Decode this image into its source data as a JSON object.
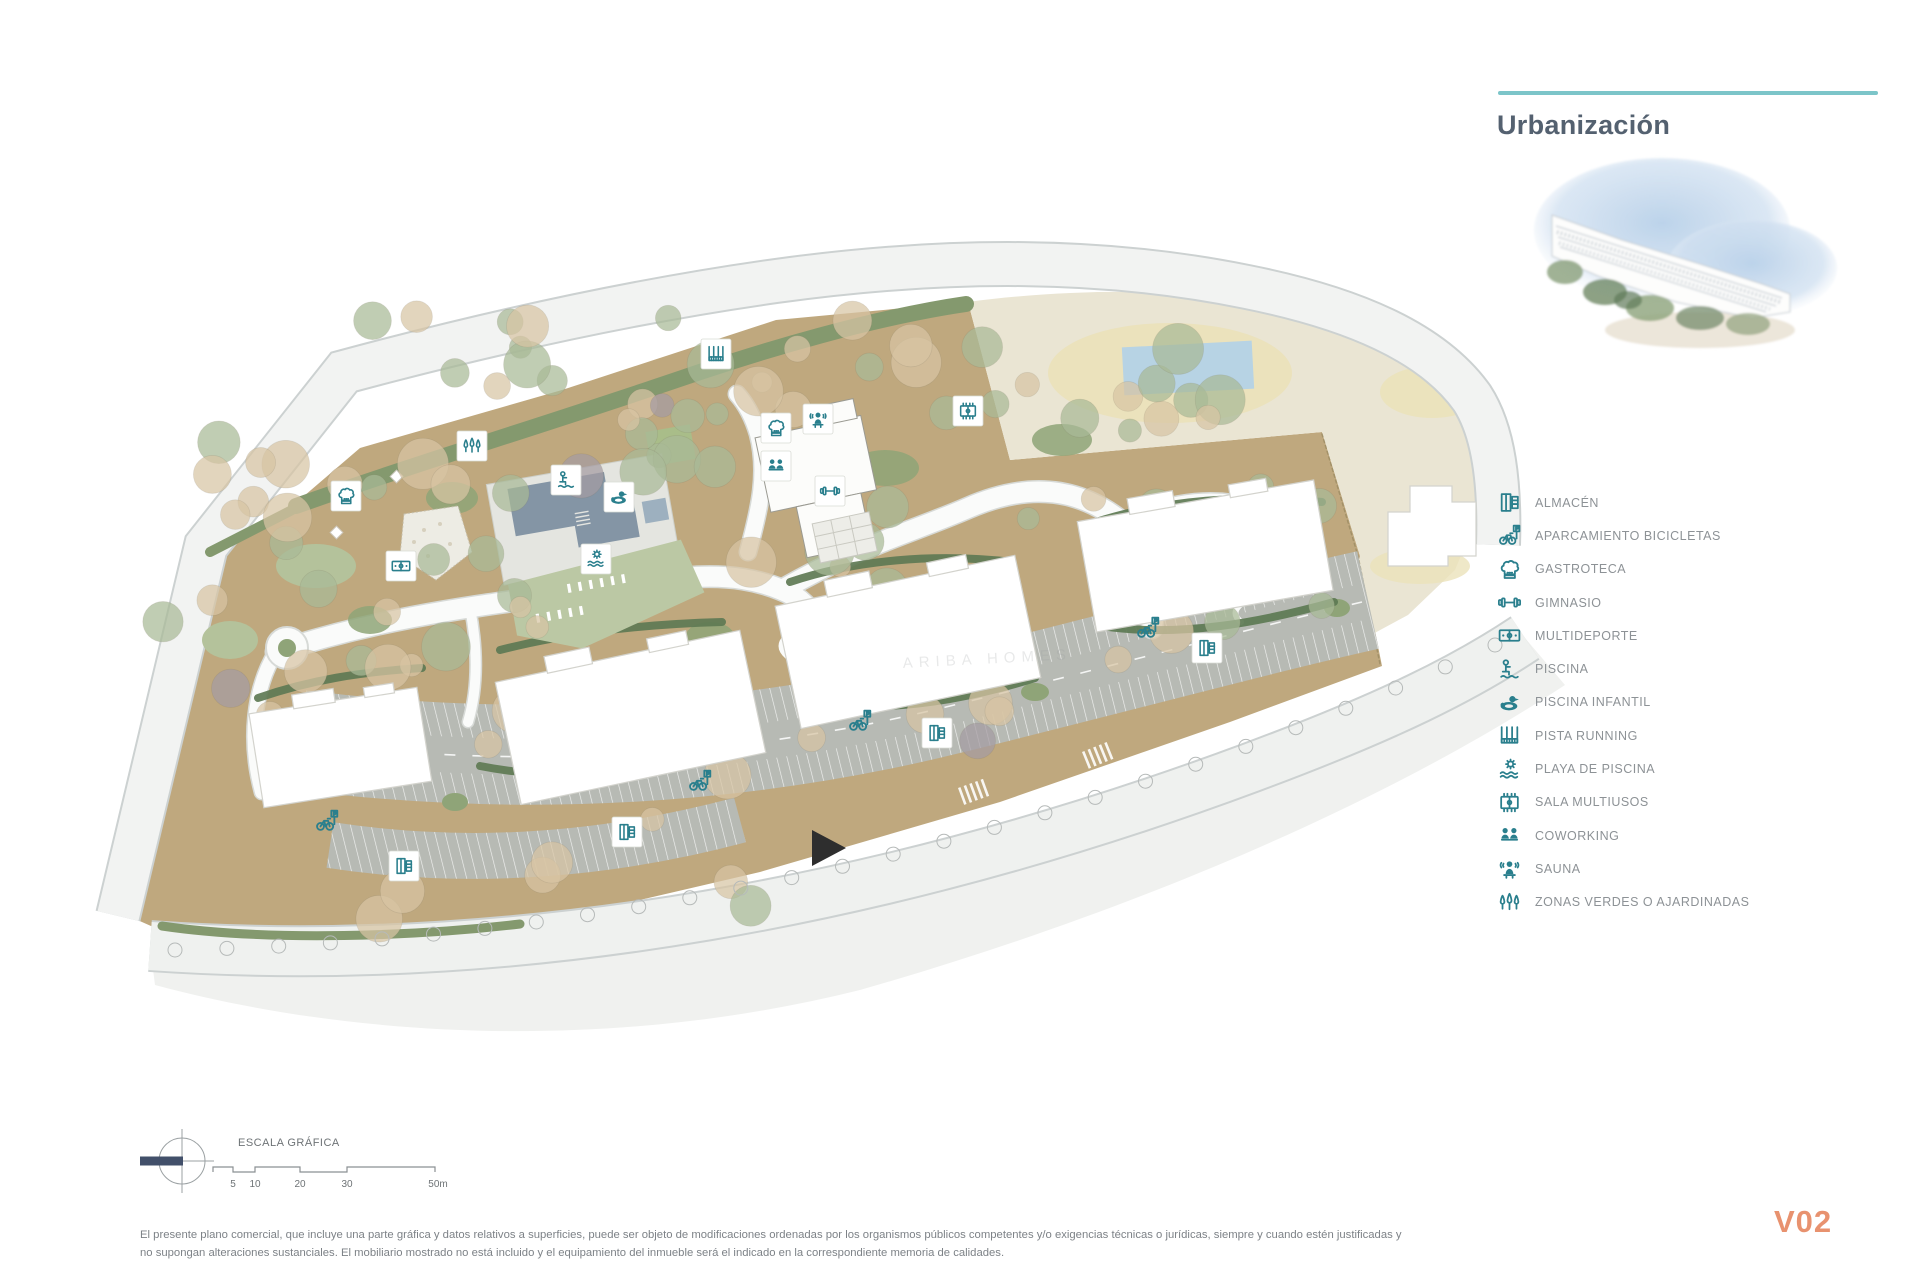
{
  "header": {
    "title": "Urbanización",
    "accent_line_color": "#7cc5c9",
    "title_color": "#546170"
  },
  "hero_image": {
    "description": "watercolor rendering of terraced apartment buildings with vegetation and blue sky"
  },
  "legend": {
    "items": [
      {
        "icon": "cabinet",
        "label": "ALMACÉN"
      },
      {
        "icon": "bike",
        "label": "APARCAMIENTO BICICLETAS"
      },
      {
        "icon": "chef",
        "label": "GASTROTECA"
      },
      {
        "icon": "gym",
        "label": "GIMNASIO"
      },
      {
        "icon": "court",
        "label": "MULTIDEPORTE"
      },
      {
        "icon": "pool",
        "label": "PISCINA"
      },
      {
        "icon": "duck",
        "label": "PISCINA INFANTIL"
      },
      {
        "icon": "track",
        "label": "PISTA RUNNING"
      },
      {
        "icon": "beach",
        "label": "PLAYA DE PISCINA"
      },
      {
        "icon": "multi",
        "label": "SALA MULTIUSOS"
      },
      {
        "icon": "cowork",
        "label": "COWORKING"
      },
      {
        "icon": "sauna",
        "label": "SAUNA"
      },
      {
        "icon": "trees",
        "label": "ZONAS VERDES O AJARDINADAS"
      }
    ]
  },
  "plan": {
    "watermark": "ARIBA HOMES",
    "colors": {
      "ground": "#bfa87e",
      "cream": "#eae5d3",
      "oval": "#ebe2ba",
      "water": "#b7d3e4",
      "pool": "#8495a5",
      "parking": "#b7bab4",
      "lawn": "#bbc8a4",
      "green_strip": "#84996e",
      "hedge": "#5e7a54",
      "icon_teal": "#2a7f8d"
    },
    "markers": [
      {
        "icon": "trees",
        "x": 472,
        "y": 446,
        "card": true
      },
      {
        "icon": "chef",
        "x": 346,
        "y": 496,
        "card": true
      },
      {
        "icon": "court",
        "x": 401,
        "y": 566,
        "card": true
      },
      {
        "icon": "track",
        "x": 716,
        "y": 354,
        "card": true
      },
      {
        "icon": "pool",
        "x": 566,
        "y": 480,
        "card": true
      },
      {
        "icon": "duck",
        "x": 619,
        "y": 497,
        "card": true
      },
      {
        "icon": "beach",
        "x": 596,
        "y": 559,
        "card": true
      },
      {
        "icon": "chef",
        "x": 776,
        "y": 428,
        "card": true
      },
      {
        "icon": "sauna",
        "x": 818,
        "y": 419,
        "card": true
      },
      {
        "icon": "cowork",
        "x": 776,
        "y": 466,
        "card": true
      },
      {
        "icon": "gym",
        "x": 830,
        "y": 491,
        "card": true
      },
      {
        "icon": "multi",
        "x": 968,
        "y": 411,
        "card": true
      },
      {
        "icon": "bike",
        "x": 327,
        "y": 821,
        "card": false
      },
      {
        "icon": "bike",
        "x": 700,
        "y": 781,
        "card": false
      },
      {
        "icon": "bike",
        "x": 860,
        "y": 721,
        "card": false
      },
      {
        "icon": "bike",
        "x": 1148,
        "y": 628,
        "card": false
      },
      {
        "icon": "cabinet",
        "x": 404,
        "y": 866,
        "card": true
      },
      {
        "icon": "cabinet",
        "x": 627,
        "y": 832,
        "card": true
      },
      {
        "icon": "cabinet",
        "x": 937,
        "y": 733,
        "card": true
      },
      {
        "icon": "cabinet",
        "x": 1207,
        "y": 648,
        "card": true
      }
    ]
  },
  "scale_bar": {
    "title": "ESCALA GRÁFICA",
    "labels": [
      "5",
      "10",
      "20",
      "30",
      "50m"
    ]
  },
  "footer": {
    "disclaimer": "El presente plano comercial, que incluye una parte gráfica y datos relativos a superficies, puede ser objeto de modificaciones ordenadas por los organismos públicos competentes y/o exigencias técnicas o jurídicas, siempre y cuando estén justificadas y no supongan alteraciones sustanciales. El mobiliario mostrado no está incluido y el equipamiento del inmueble será el indicado en la correspondiente memoria de calidades.",
    "version": "V02",
    "version_color": "#e8926f"
  }
}
